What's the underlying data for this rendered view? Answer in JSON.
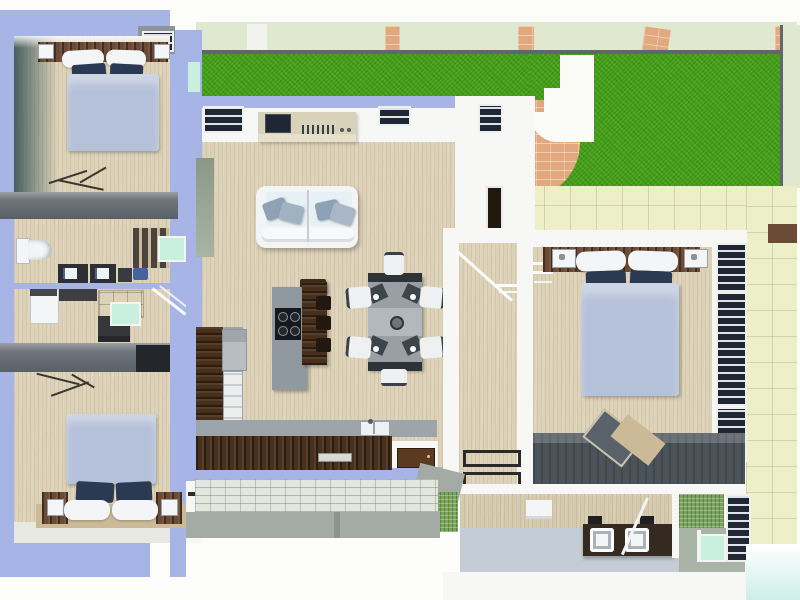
{
  "scene": {
    "title": "3D rendered top-view floor plan of a residence",
    "view": "top-down cutaway render",
    "no_visible_text": true
  },
  "palette": {
    "wall_periwinkle": "#a7b4e6",
    "floor_beige": "#ddd2b8",
    "wall_white": "#f7f8f5",
    "slab_gray": "#6e747a",
    "teal_shadow": "#45605e",
    "lawn_green": "#47a01b",
    "sage_band": "#e0e8cf",
    "brick_peach": "#e2a87e",
    "patio_tile": "#edefc9",
    "kitchen_walnut": "#472f1c",
    "counter_gray": "#9da5ab",
    "island_gray": "#8f999f",
    "cooktop_black": "#15181c",
    "steel": "#b7bdc3",
    "navy_pillow": "#2b3a52",
    "duvet_blue": "#b5c1d8",
    "linen_white": "#f3f5f7",
    "headboard_brown": "#6b4b35",
    "sofa_white": "#f2f4f5",
    "sofa_seat": "#e7f0f4",
    "cushion_gray": "#8ea1b6",
    "table_gray": "#98a0a6",
    "seat_dark": "#3d444c",
    "chair_white": "#eef0f1",
    "coffee_brown": "#3d2a1b",
    "dresser_slate": "#4b535a",
    "mint_glass": "#c9efdf",
    "mosaic_green": "#7aa35d",
    "bath_floor": "#c4cdd5",
    "walkway_gray": "#a4aba4",
    "paver_light": "#e4e6e0",
    "aqua_pool": "#cdeee8",
    "window_dark": "#1e2733",
    "door_brown": "#5a3a20",
    "rug_tan": "#ccb997",
    "appliance_dark": "#2e2f33",
    "console_beige": "#d9d2ba",
    "sage_door": "#93a18c",
    "bin_blue": "#4663a0"
  },
  "rooms": [
    {
      "id": "bedroom-top-left",
      "name": "Bedroom 1",
      "furniture": [
        "double bed",
        "navy pillows",
        "white pillows",
        "headboard shelf",
        "wall lamps",
        "clothes rack"
      ]
    },
    {
      "id": "utility-bath",
      "name": "Utility / WC",
      "furniture": [
        "toilet",
        "dark cabinets",
        "striped wardrobe",
        "mirror panel",
        "blue bin"
      ]
    },
    {
      "id": "laundry",
      "name": "Laundry / store",
      "furniture": [
        "washing machine",
        "counter",
        "cabinet grid",
        "drawer unit",
        "mirror panel",
        "stair rail"
      ]
    },
    {
      "id": "bedroom-bottom-left",
      "name": "Bedroom 2",
      "furniture": [
        "double bed",
        "two nightstands",
        "lamps",
        "tan platform",
        "clothes rack"
      ]
    },
    {
      "id": "living-room",
      "name": "Living room",
      "furniture": [
        "white sofa",
        "4 gray cushions",
        "tv console",
        "tv",
        "coffee table",
        "top-wall windows"
      ]
    },
    {
      "id": "kitchen",
      "name": "Kitchen",
      "furniture": [
        "L-shaped walnut counter",
        "gray worktop",
        "fridge",
        "double sink",
        "island with cooktop",
        "breakfast bar",
        "3 bar stools",
        "service door"
      ]
    },
    {
      "id": "dining",
      "name": "Dining area",
      "furniture": [
        "gray table",
        "6 white chairs",
        "dark seat pads",
        "center bowl"
      ]
    },
    {
      "id": "walk-in-closet",
      "name": "Walk-in closet corridor",
      "furniture": [
        "hanging rails",
        "door thresholds"
      ]
    },
    {
      "id": "master-bedroom",
      "name": "Master bedroom",
      "furniture": [
        "double bed",
        "headboard with shelves",
        "wall lamps",
        "window bay (3 windows)",
        "long slate dresser",
        "open laptop"
      ]
    },
    {
      "id": "bathroom",
      "name": "Bathroom",
      "furniture": [
        "double-sink vanity",
        "black taps",
        "glass screen",
        "mosaic shower wall",
        "mint glass panel",
        "window",
        "white shelf"
      ]
    },
    {
      "id": "garden",
      "name": "Garden / terrace",
      "furniture": [
        "lawn",
        "tiled patio",
        "brick stair wall",
        "white steps",
        "perimeter wall with brick piers"
      ]
    }
  ]
}
